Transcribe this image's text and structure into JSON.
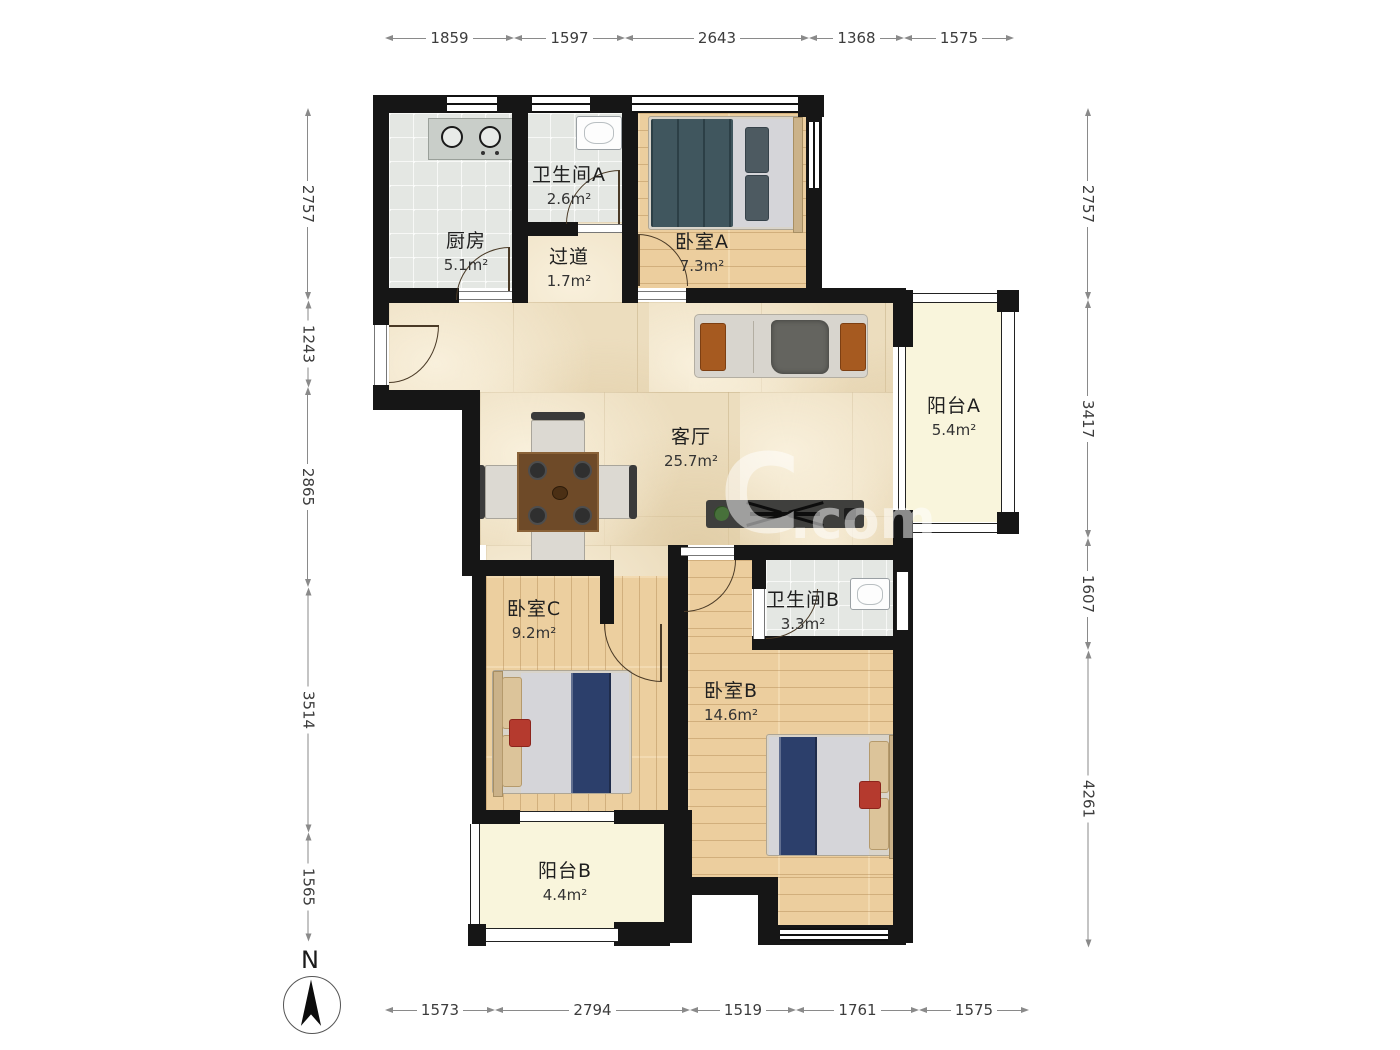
{
  "rooms": [
    {
      "id": "kitchen",
      "name": "厨房",
      "area": "5.1m²"
    },
    {
      "id": "bath-a",
      "name": "卫生间A",
      "area": "2.6m²"
    },
    {
      "id": "hallway",
      "name": "过道",
      "area": "1.7m²"
    },
    {
      "id": "bedroom-a",
      "name": "卧室A",
      "area": "7.3m²"
    },
    {
      "id": "living",
      "name": "客厅",
      "area": "25.7m²"
    },
    {
      "id": "balcony-a",
      "name": "阳台A",
      "area": "5.4m²"
    },
    {
      "id": "bedroom-c",
      "name": "卧室C",
      "area": "9.2m²"
    },
    {
      "id": "bath-b",
      "name": "卫生间B",
      "area": "3.3m²"
    },
    {
      "id": "bedroom-b",
      "name": "卧室B",
      "area": "14.6m²"
    },
    {
      "id": "balcony-b",
      "name": "阳台B",
      "area": "4.4m²"
    }
  ],
  "dimensions": {
    "top": {
      "axis": "h",
      "x": 385,
      "y": 29,
      "segments": [
        {
          "label": "1859",
          "length": 129
        },
        {
          "label": "1597",
          "length": 111
        },
        {
          "label": "2643",
          "length": 184
        },
        {
          "label": "1368",
          "length": 95
        },
        {
          "label": "1575",
          "length": 110
        }
      ]
    },
    "bottom": {
      "axis": "h",
      "x": 385,
      "y": 1001,
      "segments": [
        {
          "label": "1573",
          "length": 110
        },
        {
          "label": "2794",
          "length": 195
        },
        {
          "label": "1519",
          "length": 106
        },
        {
          "label": "1761",
          "length": 123
        },
        {
          "label": "1575",
          "length": 110
        }
      ]
    },
    "left": {
      "axis": "v",
      "x": 308,
      "y": 108,
      "segments": [
        {
          "label": "2757",
          "length": 192
        },
        {
          "label": "1243",
          "length": 87
        },
        {
          "label": "2865",
          "length": 200
        },
        {
          "label": "3514",
          "length": 245
        },
        {
          "label": "1565",
          "length": 109
        }
      ]
    },
    "right": {
      "axis": "v",
      "x": 1088,
      "y": 108,
      "segments": [
        {
          "label": "2757",
          "length": 192
        },
        {
          "label": "3417",
          "length": 238
        },
        {
          "label": "1607",
          "length": 112
        },
        {
          "label": "4261",
          "length": 297
        }
      ]
    }
  },
  "compass": {
    "label": "N"
  },
  "watermark": {
    "text": "C",
    "suffix": ".com"
  },
  "colors": {
    "wall": "#161616",
    "marble_floor": "#ecddbe",
    "wood_floor": "#ecce9e",
    "tile_floor": "#e4e7e3",
    "balcony_floor": "#f9f5dc",
    "dimension_line": "#8a8a8a",
    "dimension_text": "#3c3c3c",
    "label_text": "#1f1f1f",
    "bed_runner": "#2c3f6b",
    "sofa_pillow": "#a65a20"
  }
}
